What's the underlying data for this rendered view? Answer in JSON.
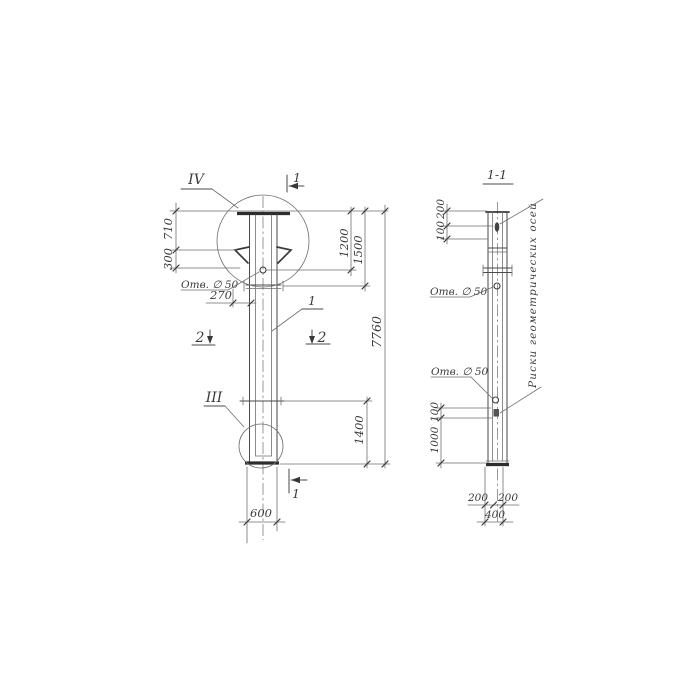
{
  "front_view": {
    "detail_top": "IV",
    "detail_bottom": "III",
    "section_mark_top": "1",
    "section_mark_bottom": "1",
    "section2_left": "2",
    "section2_right": "2",
    "part_label": "1",
    "dim_710": "710",
    "dim_300": "300",
    "hole_note": "Отв. ∅ 50",
    "dim_270": "270",
    "dim_1200": "1200",
    "dim_1500": "1500",
    "dim_7760": "7760",
    "dim_1400": "1400",
    "dim_600": "600"
  },
  "section_view": {
    "title": "1-1",
    "dim_200_top": "200",
    "dim_100_top": "100",
    "hole_note_upper": "Отв. ∅ 50",
    "hole_note_lower": "Отв. ∅ 50",
    "dim_100_bottom": "100",
    "dim_1000": "1000",
    "dim_200_left": "200",
    "dim_200_right": "200",
    "dim_400": "400",
    "axes_note": "Риски геометрических осей"
  }
}
